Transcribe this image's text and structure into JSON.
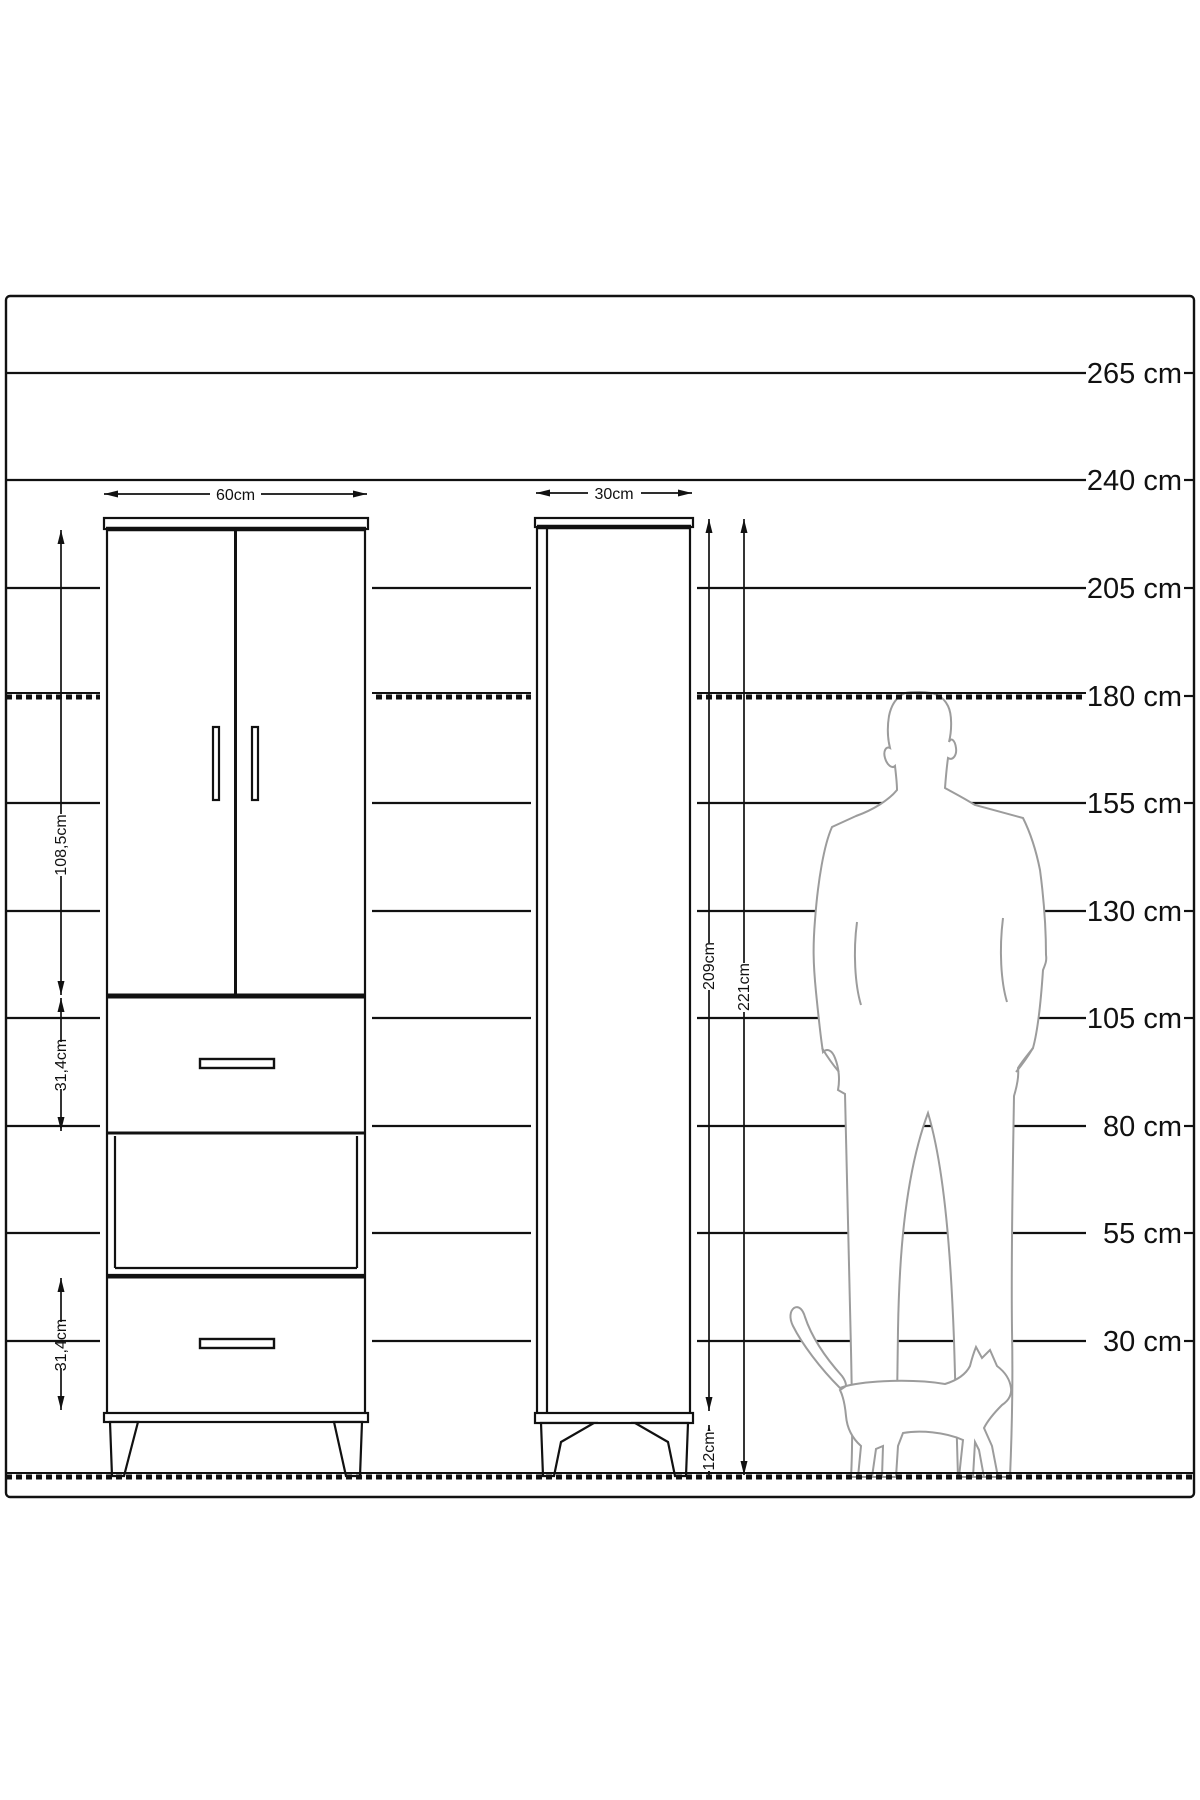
{
  "ruler": {
    "unit": "cm",
    "labels": [
      "265 cm",
      "240 cm",
      "205 cm",
      "180 cm",
      "155 cm",
      "130 cm",
      "105 cm",
      "80 cm",
      "55 cm",
      "30 cm"
    ]
  },
  "left_cabinet": {
    "width_label": "60cm",
    "door_section_height_label": "108,5cm",
    "middle_drawer_height_label": "31,4cm",
    "bottom_drawer_height_label": "31,4cm"
  },
  "right_cabinet": {
    "width_label": "30cm",
    "carcass_height_label": "209cm",
    "total_height_label": "221cm",
    "leg_height_label": "12cm"
  },
  "colors": {
    "line": "#111111",
    "figure_outline": "#9c9c9c",
    "background": "#ffffff"
  }
}
